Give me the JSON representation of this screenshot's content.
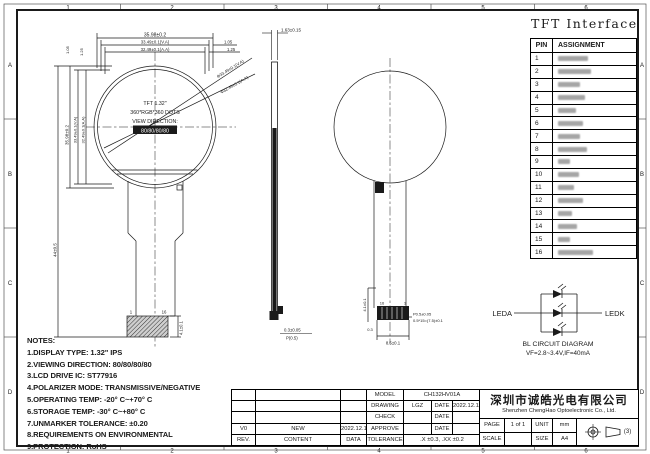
{
  "frame": {
    "zone_cols": [
      "1",
      "2",
      "3",
      "4",
      "5",
      "6"
    ],
    "zone_rows": [
      "A",
      "B",
      "C",
      "D"
    ]
  },
  "front_view": {
    "dims_top": [
      "35.98±0.2",
      "33.49±0.1(V.A)",
      "32.49±0.1(A.A)"
    ],
    "dims_top_right": [
      "1.05",
      "1.25"
    ],
    "dims_left_small": [
      "1.05",
      "1.25"
    ],
    "dims_left": [
      "35.98±0.2",
      "33.49±0.1(V.A)",
      "32.49±0.1(A.A)"
    ],
    "dim_total": "44±0.5",
    "dims_diagonal": [
      "Φ33.49±0.1(V.A)",
      "Φ32.49±0.1(A.A)"
    ],
    "panel_lines": [
      "TFT 1.32\"",
      "360*RGB*360 DOTS",
      "VIEW DIRECTION:",
      "80/80/80/80"
    ],
    "pin_first": "1",
    "pin_last": "16",
    "dim_connector": "4.1±0.1"
  },
  "side_view": {
    "dim_thickness": "1.63±0.15",
    "dim_bottom_a": "0.3±0.05",
    "dim_bottom_b": "P(0.5)"
  },
  "back_view": {
    "pin_left": "16",
    "pin_right": "1",
    "dim_height": "4.1±0.1",
    "dim_edge": "0.3",
    "dim_width": "8.5±0.1",
    "dim_pitch": "P0.5±0.05",
    "dim_span": "0.5*15=(7.5)±0.1"
  },
  "interface": {
    "title": "TFT Interface",
    "headers": [
      "PIN",
      "ASSIGNMENT"
    ],
    "pins": [
      "1",
      "2",
      "3",
      "4",
      "5",
      "6",
      "7",
      "8",
      "9",
      "10",
      "11",
      "12",
      "13",
      "14",
      "15",
      "16"
    ]
  },
  "bl": {
    "anode": "LEDA",
    "cathode": "LEDK",
    "caption": "BL CIRCUIT DIAGRAM",
    "spec": "VF=2.8~3.4V,IF=40mA"
  },
  "notes": {
    "title": "NOTES:",
    "items": [
      "1.DISPLAY TYPE:  1.32\" IPS",
      "2.VIEWING DIRECTION: 80/80/80/80",
      "3.LCD DRIVE IC: ST77916",
      "4.POLARIZER MODE: TRANSMISSIVE/NEGATIVE",
      "5.OPERATING TEMP: -20° C~+70° C",
      "6.STORAGE TEMP: -30° C~+80° C",
      "7.UNMARKER TOLERANCE: ±0.20",
      "8.REQUIREMENTS ON ENVIRONMENTAL",
      "9.PROTECTION: RoHS"
    ]
  },
  "title_block": {
    "model_label": "MODEL",
    "model": "CH132HV01A",
    "drawing_label": "DRAWING",
    "drawing": "LGZ",
    "check_label": "CHECK",
    "approve_label": "APPROVE",
    "date_label": "DATE",
    "drawing_date": "2022.12.11",
    "rev": "V0",
    "content": "NEW",
    "rev_date": "2022.12.11",
    "rev_label": "REV.",
    "content_label": "CONTENT",
    "data_label": "DATA",
    "tolerance_label": "TOLERANCE",
    "tolerance": ".X ±0.3, .XX ±0.2",
    "company_cn": "深圳市诚皓光电有限公司",
    "company_en": "Shenzhen ChengHao Optoelectronic Co., Ltd.",
    "page_label": "PAGE",
    "page": "1 of 1",
    "unit_label": "UNIT",
    "unit": "mm",
    "scale_label": "SCALE",
    "size_label": "SIZE",
    "size": "A4",
    "projection": "(3)"
  }
}
